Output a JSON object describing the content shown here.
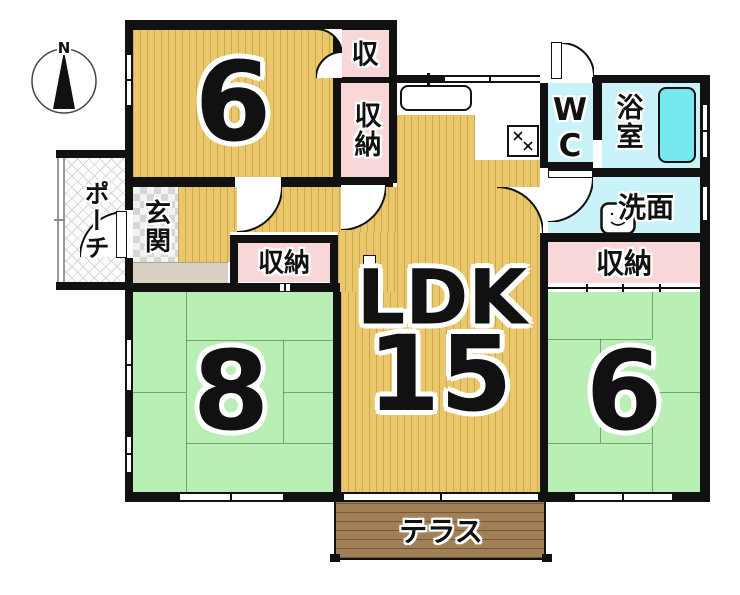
{
  "compass": {
    "north_label": "N"
  },
  "rooms": {
    "bedroom_top": {
      "size_label": "6"
    },
    "bedroom_left": {
      "size_label": "8"
    },
    "bedroom_right": {
      "size_label": "6"
    },
    "ldk": {
      "name_label": "LDK",
      "size_label": "15"
    },
    "entrance": {
      "label": "玄関"
    },
    "porch": {
      "label": "ポーチ"
    },
    "wc": {
      "label": "WC"
    },
    "bathroom": {
      "label": "浴室"
    },
    "washroom": {
      "label": "洗面"
    },
    "terrace": {
      "label": "テラス"
    }
  },
  "closets": {
    "top_small": {
      "label": "収"
    },
    "top_large": {
      "label": "収納"
    },
    "middle": {
      "label": "収納"
    },
    "east": {
      "label": "収納"
    }
  },
  "colors": {
    "wall": "#111111",
    "wood": "#e9c76a",
    "tatami": "#b9efb4",
    "closet": "#f7d7d7",
    "wet": "#c9f3f8",
    "tub": "#76e8ef",
    "terrace": "#a28057"
  }
}
